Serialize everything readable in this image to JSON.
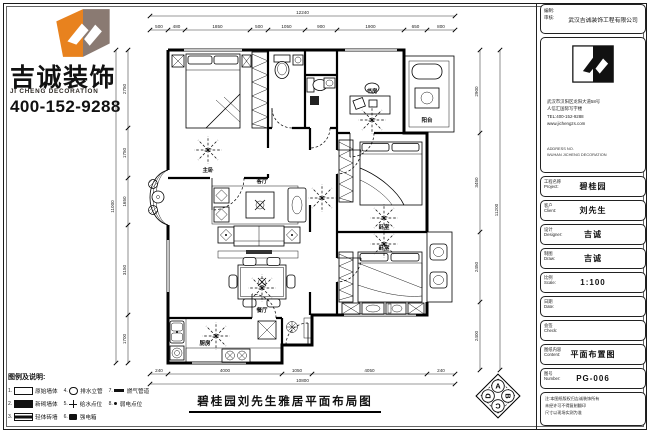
{
  "brand": {
    "name": "吉诚装饰",
    "name_en": "JI CHENG DECORATION",
    "phone": "400-152-9288",
    "logo_orange": "#e8821e",
    "logo_taupe": "#8a7a72"
  },
  "legend": {
    "title": "图例及说明:",
    "columns": [
      [
        {
          "idx": "1.",
          "sym": "rect-outline",
          "label": "原始墙体"
        },
        {
          "idx": "2.",
          "sym": "rect-filled",
          "label": "新砌墙体"
        },
        {
          "idx": "3.",
          "sym": "rect-half",
          "label": "轻体砖墙"
        }
      ],
      [
        {
          "idx": "4.",
          "sym": "circle",
          "label": "排水立管"
        },
        {
          "idx": "5.",
          "sym": "plus",
          "label": "给水点位"
        },
        {
          "idx": "6.",
          "sym": "square",
          "label": "强电箱"
        }
      ],
      [
        {
          "idx": "7.",
          "sym": "dash",
          "label": "燃气管道"
        },
        {
          "idx": "8.",
          "sym": "dot",
          "label": "弱电点位"
        }
      ]
    ]
  },
  "plan": {
    "title": "碧桂园刘先生雅居平面布局图",
    "rooms": [
      "主卧",
      "书房",
      "客厅",
      "餐厅",
      "厨房",
      "卧室",
      "卧室",
      "阳台"
    ],
    "dims": {
      "top_overall": [
        "12240"
      ],
      "top": [
        "500",
        "480",
        "1850",
        "500",
        "1050",
        "900",
        "1900",
        "650",
        "800"
      ],
      "left_overall": [
        "11000"
      ],
      "left": [
        "2750",
        "1750",
        "1650",
        "3150",
        "1700"
      ],
      "right": [
        "2900",
        "3450",
        "2450",
        "2400"
      ],
      "right_overall": [
        "11200"
      ],
      "bottom": [
        "240",
        "4000",
        "1050",
        "4050",
        "240"
      ],
      "bottom_overall": [
        "10800"
      ]
    }
  },
  "compass": {
    "letters": [
      "A",
      "B",
      "C",
      "D"
    ]
  },
  "titleblock": {
    "header": {
      "label_top": "编制:",
      "label_bottom": "审核:",
      "company": "武汉吉诚装饰工程有限公司"
    },
    "address_lines": [
      "武汉市汉阳区龙阳大道58号",
      "人信汇国际写字楼",
      "TEL:400-152-9288",
      "www.jichengzs.com"
    ],
    "footer_lines": [
      "ADDRESS NO.",
      "WUHAN JICHENG DECORATION"
    ],
    "fields": [
      {
        "label": "工程名称",
        "label_en": "Project:",
        "value": "碧桂园"
      },
      {
        "label": "客户",
        "label_en": "Client:",
        "value": "刘先生"
      },
      {
        "label": "设计",
        "label_en": "Designer:",
        "value": "吉诚"
      },
      {
        "label": "制图",
        "label_en": "Draw:",
        "value": "吉诚"
      },
      {
        "label": "比例",
        "label_en": "Scale:",
        "value": "1:100"
      },
      {
        "label": "日期",
        "label_en": "Date:",
        "value": ""
      },
      {
        "label": "会签",
        "label_en": "Check:",
        "value": ""
      },
      {
        "label": "图纸内容",
        "label_en": "Content:",
        "value": "平面布置图"
      },
      {
        "label": "图号",
        "label_en": "Number:",
        "value": "PG-006"
      }
    ],
    "notes": [
      "注:本图纸版权归吉诚装饰所有",
      "未经许可不得复制翻印",
      "尺寸以现场实测为准"
    ]
  }
}
